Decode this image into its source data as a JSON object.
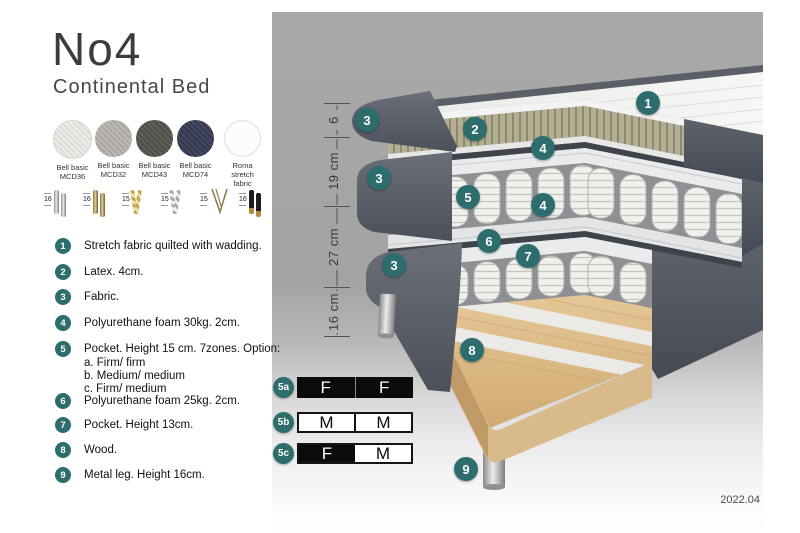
{
  "header": {
    "title": "No4",
    "subtitle": "Continental Bed"
  },
  "swatches": [
    {
      "line1": "Bell basic",
      "line2": "MCD36"
    },
    {
      "line1": "Bell basic",
      "line2": "MCD32"
    },
    {
      "line1": "Bell basic",
      "line2": "MCD43"
    },
    {
      "line1": "Bell basic",
      "line2": "MCD74"
    },
    {
      "line1": "Roma",
      "line2": "stretch fabric"
    }
  ],
  "legs": [
    {
      "height": "16",
      "type": "cylinder-silver"
    },
    {
      "height": "16",
      "type": "cylinder-brass"
    },
    {
      "height": "15",
      "type": "twisted-gold"
    },
    {
      "height": "15",
      "type": "twisted-silver"
    },
    {
      "height": "15",
      "type": "hairpin-brass"
    },
    {
      "height": "16",
      "type": "cylinder-black-brass"
    }
  ],
  "legend": {
    "items": [
      {
        "num": "1",
        "text": "Stretch fabric quilted with wadding."
      },
      {
        "num": "2",
        "text": "Latex. 4cm."
      },
      {
        "num": "3",
        "text": "Fabric."
      },
      {
        "num": "4",
        "text": "Polyurethane foam 30kg. 2cm."
      },
      {
        "num": "5",
        "text": "Pocket. Height 15 cm. 7zones. Option:",
        "options": [
          "a. Firm/ firm",
          "b. Medium/ medium",
          "c. Firm/ medium"
        ]
      },
      {
        "num": "6",
        "text": "Polyurethane foam 25kg. 2cm."
      },
      {
        "num": "7",
        "text": "Pocket. Height 13cm."
      },
      {
        "num": "8",
        "text": "Wood."
      },
      {
        "num": "9",
        "text": "Metal leg. Height 16cm."
      }
    ]
  },
  "diagram": {
    "callouts": [
      "1",
      "2",
      "3",
      "3",
      "3",
      "4",
      "4",
      "5",
      "6",
      "7",
      "8",
      "9"
    ],
    "dimensions": [
      "6",
      "19 cm",
      "27 cm",
      "16 cm"
    ]
  },
  "tables": {
    "rows": [
      {
        "id": "5a",
        "cells": [
          "F",
          "F"
        ]
      },
      {
        "id": "5b",
        "cells": [
          "M",
          "M"
        ]
      },
      {
        "id": "5c",
        "cells": [
          "F",
          "M"
        ]
      }
    ]
  },
  "footer": {
    "version": "2022.04"
  },
  "colors": {
    "accent": "#2e6d6e",
    "fabric": "#51565f",
    "latex": "#b4af92",
    "wood": "#dcbc8c"
  }
}
